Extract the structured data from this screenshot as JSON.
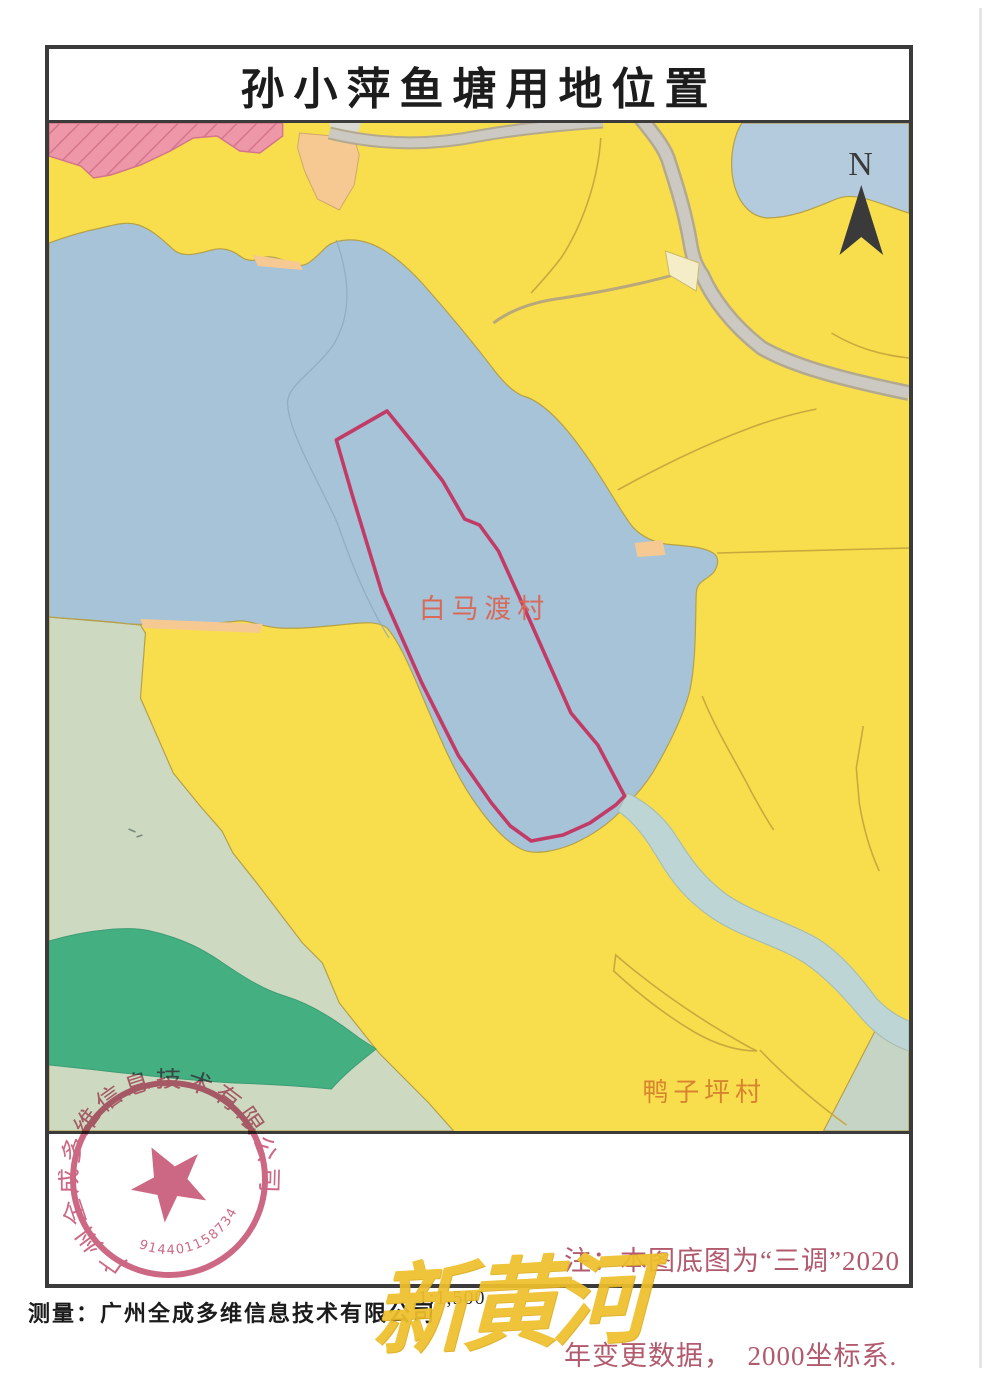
{
  "title": "孙小萍鱼塘用地位置",
  "north_label": "N",
  "map": {
    "village_label_1": "白马渡村",
    "village_label_2": "鸭子坪村"
  },
  "note": {
    "line1": "注：本图底图为“三调”2020",
    "line2": "年变更数据，  2000坐标系."
  },
  "footer": {
    "scale": "1:1,500",
    "surveyor": "测量：广州全成多维信息技术有限公司"
  },
  "stamp": {
    "company": "广州全成多维信息技术有限公司",
    "registration_number": "914401158734874746"
  },
  "watermark": "新黄河",
  "colors": {
    "land_yellow": "#f8de4c",
    "water_blue": "#a7c3d7",
    "corner_blue": "#b3cbdc",
    "pale_green": "#cddac1",
    "dark_green": "#44b082",
    "corner_green": "#c6d4c6",
    "pink_hatch": "#ee97a9",
    "peach": "#f6c992",
    "road_gray": "#cbc9c2",
    "stream_blue": "#bed5d6",
    "cream": "#f4edc8",
    "boundary_red": "#c23a66",
    "label_orange": "#d8832f",
    "label_salmon": "#d86a5a",
    "note_red": "#b25a6e",
    "stamp_red": "#c2476a",
    "watermark_yellow": "#eec02c",
    "north_black": "#3a3a3a"
  }
}
